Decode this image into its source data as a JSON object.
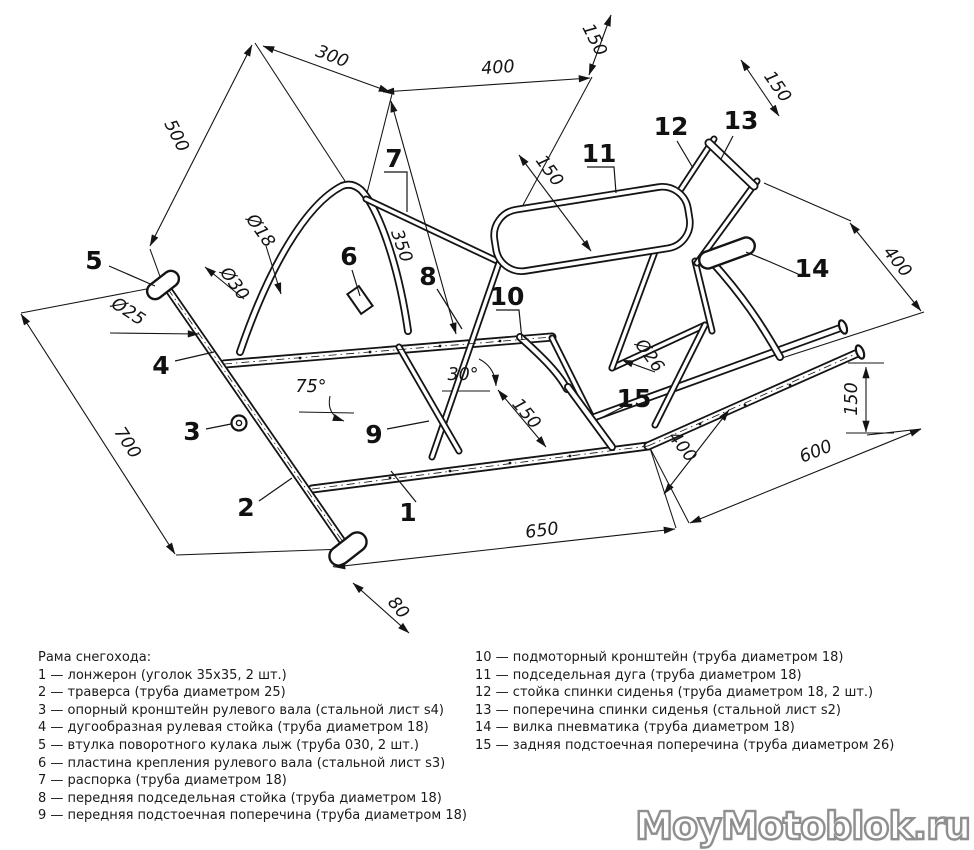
{
  "page": {
    "background": "#ffffff",
    "ink": "#141414"
  },
  "legend": {
    "title": "Рама снегохода:",
    "left_items": [
      "1 — лонжерон (уголок 35х35, 2 шт.)",
      "2 — траверса (труба диаметром 25)",
      "3 — опорный кронштейн рулевого вала (стальной лист s4)",
      "4 — дугообразная рулевая стойка (труба диаметром 18)",
      "5 — втулка поворотного кулака лыж (труба 030, 2 шт.)",
      "6 — пластина крепления рулевого вала (стальной лист s3)",
      "7 — распорка (труба диаметром 18)",
      "8 — передняя подседельная стойка (труба диаметром 18)",
      "9 — передняя подстоечная поперечина (труба диаметром 18)"
    ],
    "right_items": [
      "10 — подмоторный кронштейн (труба диаметром 18)",
      "11 — подседельная дуга (труба диаметром 18)",
      "12 — стойка спинки сиденья (труба диаметром 18, 2 шт.)",
      "13 — поперечина спинки сиденья (стальной лист s2)",
      "14 — вилка пневматика (труба диаметром 18)",
      "15 — задняя подстоечная поперечина (труба диаметром 26)"
    ]
  },
  "watermark": {
    "text": "MoyMotoblok.ru",
    "fill": "#ffffff",
    "outline": "#8f8f8f"
  },
  "diagram": {
    "dimensions": [
      {
        "t": "500",
        "x": 176,
        "y": 136,
        "r": 63,
        "line": [
          252,
          45,
          150,
          246
        ],
        "a": "both"
      },
      {
        "t": "300",
        "x": 332,
        "y": 57,
        "r": 21,
        "line": [
          263,
          46,
          390,
          92
        ],
        "a": "both"
      },
      {
        "t": "400",
        "x": 498,
        "y": 68,
        "r": -4,
        "line": [
          383,
          92,
          590,
          78
        ],
        "a": "both"
      },
      {
        "t": "150",
        "x": 594,
        "y": 40,
        "r": 63,
        "line": [
          611,
          15,
          589,
          75
        ],
        "a": "both"
      },
      {
        "t": "150",
        "x": 777,
        "y": 87,
        "r": 55,
        "line": [
          741,
          60,
          779,
          116
        ],
        "a": "both"
      },
      {
        "t": "400",
        "x": 897,
        "y": 262,
        "r": 51,
        "line": [
          850,
          223,
          921,
          311
        ],
        "a": "both"
      },
      {
        "t": "150",
        "x": 549,
        "y": 171,
        "r": 54,
        "line": [
          519,
          155,
          591,
          251
        ],
        "a": "both"
      },
      {
        "t": "350",
        "x": 401,
        "y": 246,
        "r": 71,
        "line": [
          391,
          101,
          456,
          334
        ],
        "a": "both"
      },
      {
        "t": "150",
        "x": 526,
        "y": 414,
        "r": 50,
        "line": [
          498,
          390,
          546,
          447
        ],
        "a": "both"
      },
      {
        "t": "700",
        "x": 127,
        "y": 443,
        "r": 57,
        "line": [
          21,
          314,
          175,
          554
        ],
        "a": "both"
      },
      {
        "t": "80",
        "x": 398,
        "y": 608,
        "r": 50,
        "line": [
          353,
          583,
          409,
          633
        ],
        "a": "both"
      },
      {
        "t": "650",
        "x": 542,
        "y": 531,
        "r": -7,
        "line": [
          334,
          567,
          675,
          529
        ],
        "a": "both"
      },
      {
        "t": "400",
        "x": 682,
        "y": 447,
        "r": 52,
        "line": [
          729,
          410,
          664,
          494
        ],
        "a": "both"
      },
      {
        "t": "600",
        "x": 816,
        "y": 452,
        "r": -22,
        "line": [
          690,
          523,
          921,
          429
        ],
        "a": "both"
      },
      {
        "t": "150",
        "x": 852,
        "y": 399,
        "r": -90,
        "line": [
          866,
          367,
          866,
          432
        ],
        "a": "both"
      },
      {
        "t": "75°",
        "x": 311,
        "y": 387,
        "r": 0
      },
      {
        "t": "30°",
        "x": 463,
        "y": 375,
        "r": 0
      },
      {
        "t": "Ø18",
        "x": 260,
        "y": 231,
        "r": 55,
        "line": [
          266,
          246,
          281,
          294
        ],
        "a": "end"
      },
      {
        "t": "Ø30",
        "x": 234,
        "y": 284,
        "r": 54,
        "line": [
          244,
          299,
          205,
          267
        ],
        "a": "end"
      },
      {
        "t": "Ø25",
        "x": 128,
        "y": 312,
        "r": 33,
        "line": [
          110,
          333,
          199,
          334
        ],
        "a": "end"
      },
      {
        "t": "Ø26",
        "x": 649,
        "y": 356,
        "r": 54,
        "line": [
          655,
          372,
          622,
          360
        ],
        "a": "end"
      }
    ],
    "parts": [
      {
        "n": "1",
        "x": 408,
        "y": 514,
        "leader": [
          [
            416,
            502
          ],
          [
            391,
            471
          ]
        ]
      },
      {
        "n": "2",
        "x": 246,
        "y": 509,
        "leader": [
          [
            259,
            501
          ],
          [
            292,
            478
          ]
        ]
      },
      {
        "n": "3",
        "x": 192,
        "y": 433,
        "leader": [
          [
            206,
            429
          ],
          [
            231,
            424
          ]
        ]
      },
      {
        "n": "4",
        "x": 161,
        "y": 367,
        "leader": [
          [
            175,
            361
          ],
          [
            214,
            352
          ]
        ]
      },
      {
        "n": "5",
        "x": 94,
        "y": 262,
        "leader": [
          [
            109,
            266
          ],
          [
            155,
            286
          ]
        ]
      },
      {
        "n": "6",
        "x": 349,
        "y": 258,
        "leader": [
          [
            352,
            270
          ],
          [
            360,
            296
          ]
        ]
      },
      {
        "n": "7",
        "x": 394,
        "y": 160,
        "leader": [
          [
            384,
            172
          ],
          [
            407,
            172
          ],
          [
            407,
            212
          ]
        ]
      },
      {
        "n": "8",
        "x": 428,
        "y": 278,
        "leader": [
          [
            437,
            289
          ],
          [
            462,
            329
          ]
        ]
      },
      {
        "n": "9",
        "x": 374,
        "y": 436,
        "leader": [
          [
            387,
            429
          ],
          [
            429,
            421
          ]
        ]
      },
      {
        "n": "10",
        "x": 507,
        "y": 298,
        "leader": [
          [
            496,
            310
          ],
          [
            519,
            310
          ],
          [
            522,
            340
          ]
        ]
      },
      {
        "n": "11",
        "x": 599,
        "y": 155,
        "leader": [
          [
            587,
            167
          ],
          [
            614,
            167
          ],
          [
            616,
            193
          ]
        ]
      },
      {
        "n": "12",
        "x": 671,
        "y": 128,
        "leader": [
          [
            677,
            141
          ],
          [
            693,
            168
          ]
        ]
      },
      {
        "n": "13",
        "x": 741,
        "y": 122,
        "leader": [
          [
            733,
            136
          ],
          [
            721,
            159
          ]
        ]
      },
      {
        "n": "14",
        "x": 812,
        "y": 270,
        "leader": [
          [
            798,
            274
          ],
          [
            768,
            261
          ],
          [
            746,
            252
          ]
        ]
      },
      {
        "n": "15",
        "x": 634,
        "y": 400,
        "leader": [
          [
            623,
            407
          ],
          [
            597,
            420
          ]
        ]
      }
    ]
  }
}
